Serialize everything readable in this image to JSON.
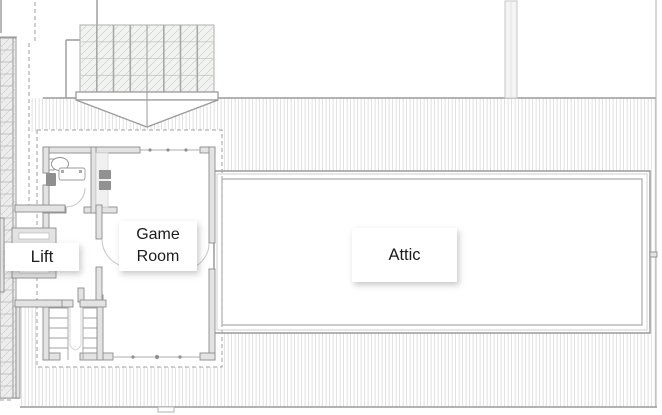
{
  "plan": {
    "type": "architectural-floor-plan",
    "rooms": [
      {
        "id": "lift",
        "label": "Lift"
      },
      {
        "id": "game_room",
        "label": "Game Room"
      },
      {
        "id": "attic",
        "label": "Attic"
      }
    ],
    "features": [
      "skylight-grid",
      "dormer-arrow",
      "roof-hatching",
      "eaves-dashed-outline",
      "staircase",
      "bathroom",
      "toilet",
      "sink",
      "vanity",
      "lift-shaft",
      "chimney",
      "glazed-side-strip",
      "door-swing-arcs"
    ]
  },
  "colors": {
    "wall_line": "#8c8c8c",
    "wall_fill": "#e3e3e3",
    "hatch_line": "#dadada",
    "dashed_line": "#9f9f9f",
    "label_bg": "#ffffff",
    "label_text": "#1c1c1c"
  }
}
